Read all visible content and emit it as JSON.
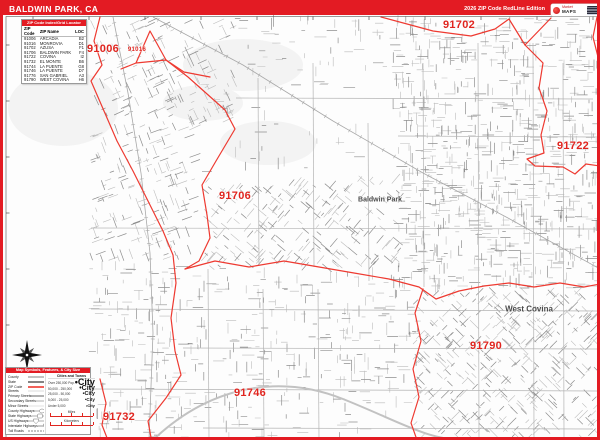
{
  "header": {
    "title": "BALDWIN PARK, CA",
    "edition": "2026 ZIP Code RedLine Edition",
    "logo": {
      "top": "Market",
      "bottom": "MAPS"
    }
  },
  "index_table": {
    "header": "ZIP Code Index/Grid Locator",
    "columns": [
      "ZIP Code",
      "ZIP Name",
      "LOC"
    ],
    "rows": [
      [
        "91006",
        "ARCADIA",
        "B2"
      ],
      [
        "91016",
        "MONROVIA",
        "D1"
      ],
      [
        "91702",
        "AZUSA",
        "F1"
      ],
      [
        "91706",
        "BALDWIN PARK",
        "F4"
      ],
      [
        "91722",
        "COVINA",
        "I2"
      ],
      [
        "91732",
        "EL MONTE",
        "B6"
      ],
      [
        "91744",
        "LA PUENTE",
        "G8"
      ],
      [
        "91746",
        "LA PUENTE",
        "D7"
      ],
      [
        "91776",
        "SAN GABRIEL",
        "A3"
      ],
      [
        "91790",
        "WEST COVINA",
        "H6"
      ]
    ]
  },
  "map": {
    "zip_labels": [
      {
        "text": "91006",
        "x": 100,
        "y": 46,
        "size": 11
      },
      {
        "text": "91016",
        "x": 134,
        "y": 47,
        "size": 6
      },
      {
        "text": "91702",
        "x": 456,
        "y": 22,
        "size": 11
      },
      {
        "text": "91722",
        "x": 570,
        "y": 143,
        "size": 11
      },
      {
        "text": "91706",
        "x": 232,
        "y": 193,
        "size": 11
      },
      {
        "text": "91790",
        "x": 483,
        "y": 343,
        "size": 11
      },
      {
        "text": "91746",
        "x": 247,
        "y": 390,
        "size": 11
      },
      {
        "text": "91732",
        "x": 116,
        "y": 414,
        "size": 11
      }
    ],
    "city_labels": [
      {
        "text": "Baldwin Park",
        "x": 377,
        "y": 197,
        "size": 7
      },
      {
        "text": "West Covina",
        "x": 526,
        "y": 306,
        "size": 8
      }
    ],
    "boundaries": [
      {
        "name": "west",
        "points": [
          [
            97,
            14
          ],
          [
            91,
            38
          ],
          [
            99,
            62
          ],
          [
            88,
            78
          ],
          [
            101,
            108
          ],
          [
            114,
            138
          ],
          [
            130,
            168
          ],
          [
            146,
            200
          ],
          [
            160,
            228
          ],
          [
            170,
            252
          ],
          [
            173,
            280
          ],
          [
            168,
            315
          ],
          [
            172,
            348
          ],
          [
            178,
            372
          ],
          [
            163,
            395
          ],
          [
            145,
            418
          ],
          [
            149,
            440
          ]
        ]
      },
      {
        "name": "northwest-wedge",
        "points": [
          [
            118,
            66
          ],
          [
            133,
            60
          ],
          [
            147,
            28
          ],
          [
            163,
            57
          ],
          [
            181,
            69
          ],
          [
            207,
            74
          ]
        ]
      },
      {
        "name": "wedge-close",
        "points": [
          [
            133,
            60
          ],
          [
            163,
            57
          ]
        ]
      },
      {
        "name": "diagonal",
        "points": [
          [
            163,
            57
          ],
          [
            185,
            74
          ],
          [
            222,
            107
          ],
          [
            232,
            126
          ],
          [
            213,
            158
          ],
          [
            199,
            182
          ],
          [
            204,
            212
          ],
          [
            207,
            235
          ],
          [
            196,
            258
          ],
          [
            182,
            266
          ]
        ]
      },
      {
        "name": "north",
        "points": [
          [
            378,
            14
          ],
          [
            430,
            28
          ],
          [
            468,
            33
          ],
          [
            492,
            26
          ],
          [
            506,
            16
          ],
          [
            522,
            42
          ],
          [
            548,
            15
          ]
        ]
      },
      {
        "name": "northeast",
        "points": [
          [
            522,
            42
          ],
          [
            540,
            60
          ],
          [
            536,
            85
          ],
          [
            544,
            108
          ],
          [
            538,
            132
          ],
          [
            541,
            150
          ],
          [
            524,
            156
          ],
          [
            532,
            163
          ],
          [
            560,
            164
          ],
          [
            572,
            171
          ],
          [
            583,
            161
          ],
          [
            597,
            163
          ]
        ]
      },
      {
        "name": "east-edge",
        "points": [
          [
            594,
            14
          ],
          [
            590,
            34
          ],
          [
            595,
            54
          ]
        ]
      },
      {
        "name": "mid",
        "points": [
          [
            182,
            266
          ],
          [
            212,
            258
          ],
          [
            246,
            264
          ],
          [
            281,
            258
          ],
          [
            316,
            264
          ],
          [
            351,
            270
          ],
          [
            386,
            276
          ],
          [
            416,
            284
          ],
          [
            433,
            296
          ],
          [
            456,
            288
          ],
          [
            481,
            283
          ],
          [
            506,
            280
          ],
          [
            531,
            284
          ],
          [
            557,
            280
          ],
          [
            581,
            284
          ],
          [
            597,
            281
          ]
        ]
      },
      {
        "name": "south-divider",
        "points": [
          [
            420,
            286
          ],
          [
            412,
            310
          ],
          [
            418,
            338
          ],
          [
            410,
            366
          ],
          [
            416,
            394
          ],
          [
            408,
            420
          ],
          [
            414,
            437
          ]
        ]
      },
      {
        "name": "southwest",
        "points": [
          [
            97,
            376
          ],
          [
            103,
            400
          ],
          [
            99,
            422
          ],
          [
            106,
            440
          ]
        ]
      }
    ],
    "railroads": [
      {
        "points": [
          [
            150,
            14
          ],
          [
            240,
            62
          ],
          [
            330,
            118
          ],
          [
            420,
            170
          ],
          [
            505,
            215
          ],
          [
            597,
            266
          ]
        ]
      },
      {
        "points": [
          [
            110,
            14
          ],
          [
            125,
            90
          ],
          [
            138,
            170
          ],
          [
            147,
            250
          ],
          [
            150,
            330
          ],
          [
            146,
            437
          ]
        ]
      }
    ]
  },
  "legend": {
    "title": "Map Symbols, Features, & City Size",
    "line_items": [
      {
        "label": "County",
        "style": "county"
      },
      {
        "label": "State",
        "style": "state"
      },
      {
        "label": "ZIP Code",
        "style": "zip"
      },
      {
        "label": "Streets",
        "style": "street"
      },
      {
        "label": "Primary Streets",
        "style": "primary"
      },
      {
        "label": "Secondary Streets",
        "style": "secondary"
      },
      {
        "label": "Minor Streets",
        "style": "minor"
      },
      {
        "label": "County Highways",
        "style": "county-hwy"
      },
      {
        "label": "State Highways",
        "style": "state-hwy"
      },
      {
        "label": "US Highways",
        "style": "us-hwy"
      },
      {
        "label": "Interstate Highways",
        "style": "interstate"
      },
      {
        "label": "Toll Roads",
        "style": "toll"
      }
    ],
    "cities_header": "Cities and Towns",
    "city_sizes": [
      {
        "label": "Over 250,000 Pop.",
        "sample": "•City",
        "size": 9
      },
      {
        "label": "50,000 - 250,000",
        "sample": "•City",
        "size": 7
      },
      {
        "label": "25,000 - 50,000",
        "sample": "•City",
        "size": 5.5
      },
      {
        "label": "5,000 - 25,000",
        "sample": "•City",
        "size": 4.5
      },
      {
        "label": "Under 5,000",
        "sample": "•City",
        "size": 4
      }
    ],
    "scales": [
      {
        "label": "Miles"
      },
      {
        "label": "Kilometers"
      }
    ]
  },
  "colors": {
    "accent": "#e31b23",
    "boundary": "#ee3a31",
    "zip_label": "#e0251f",
    "city_label": "#4a4a4a",
    "street_light": "#bcbcbc",
    "street_dark": "#8e8e8e",
    "rail": "#a8a8a8"
  }
}
